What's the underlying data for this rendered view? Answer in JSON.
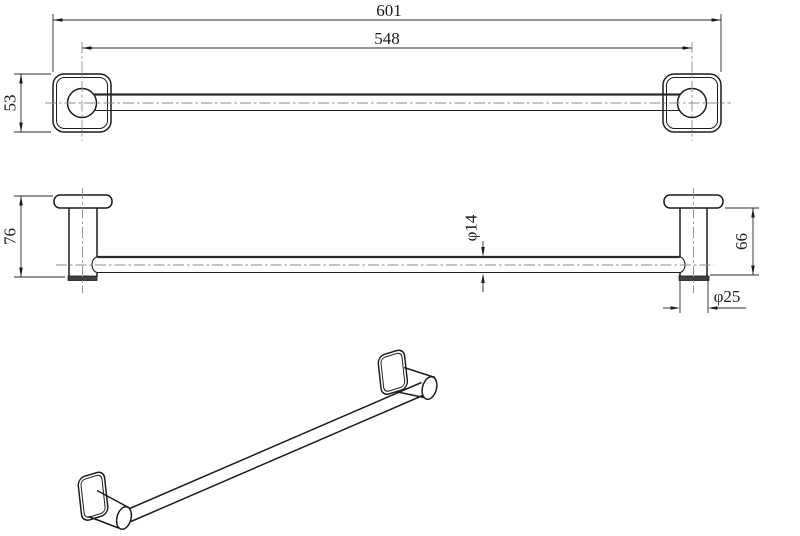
{
  "drawing": {
    "background": "#ffffff",
    "line_color": "#1c1c1c",
    "centerline_color": "#8c8c8c",
    "front_view": {
      "dim_overall_length": "601",
      "dim_center_distance": "548",
      "dim_plate_size": "53"
    },
    "side_view": {
      "dim_total_projection": "76",
      "dim_bar_diameter": "φ14",
      "dim_plate_to_tip": "66",
      "dim_post_diameter": "φ25"
    }
  }
}
